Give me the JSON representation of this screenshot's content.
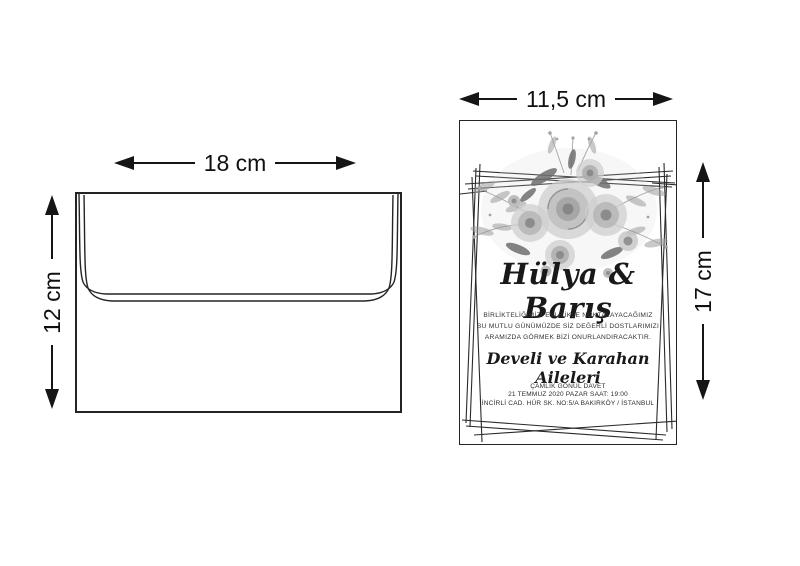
{
  "colors": {
    "background": "#ffffff",
    "line": "#151515",
    "text": "#101010",
    "card_text": "#191919",
    "floral_light": "#cfcfcf",
    "floral_mid": "#a3a3a3",
    "floral_dark": "#6f6f6f"
  },
  "icons": {
    "arrow_left": "css-triangle-left",
    "arrow_right": "css-triangle-right",
    "arrow_up": "css-triangle-up",
    "arrow_down": "css-triangle-down",
    "floral_bouquet": "svg-illustration",
    "geometric_frame": "svg-lines"
  },
  "envelope_diagram": {
    "width_label": "18 cm",
    "height_label": "12 cm"
  },
  "invitation_diagram": {
    "width_label": "11,5 cm",
    "height_label": "17 cm",
    "card": {
      "couple_names": "Hülya & Barış",
      "message_lines": [
        "BİRLİKTELİĞİMİZİ EVLİLİKLE NOKTALAYACAĞIMIZ",
        "BU MUTLU GÜNÜMÜZDE SİZ DEĞERLİ DOSTLARIMIZI",
        "ARAMIZDA GÖRMEK BİZİ ONURLANDIRACAKTIR."
      ],
      "families_line": "Develi ve Karahan Aileleri",
      "venue_line": "ÇAMLIK GÖNÜL DAVET",
      "datetime_line": "21 TEMMUZ 2020 PAZAR SAAT: 19:00",
      "address_line": "İNCİRLİ CAD. HÜR SK. NO:5/A BAKIRKÖY / İSTANBUL"
    }
  }
}
